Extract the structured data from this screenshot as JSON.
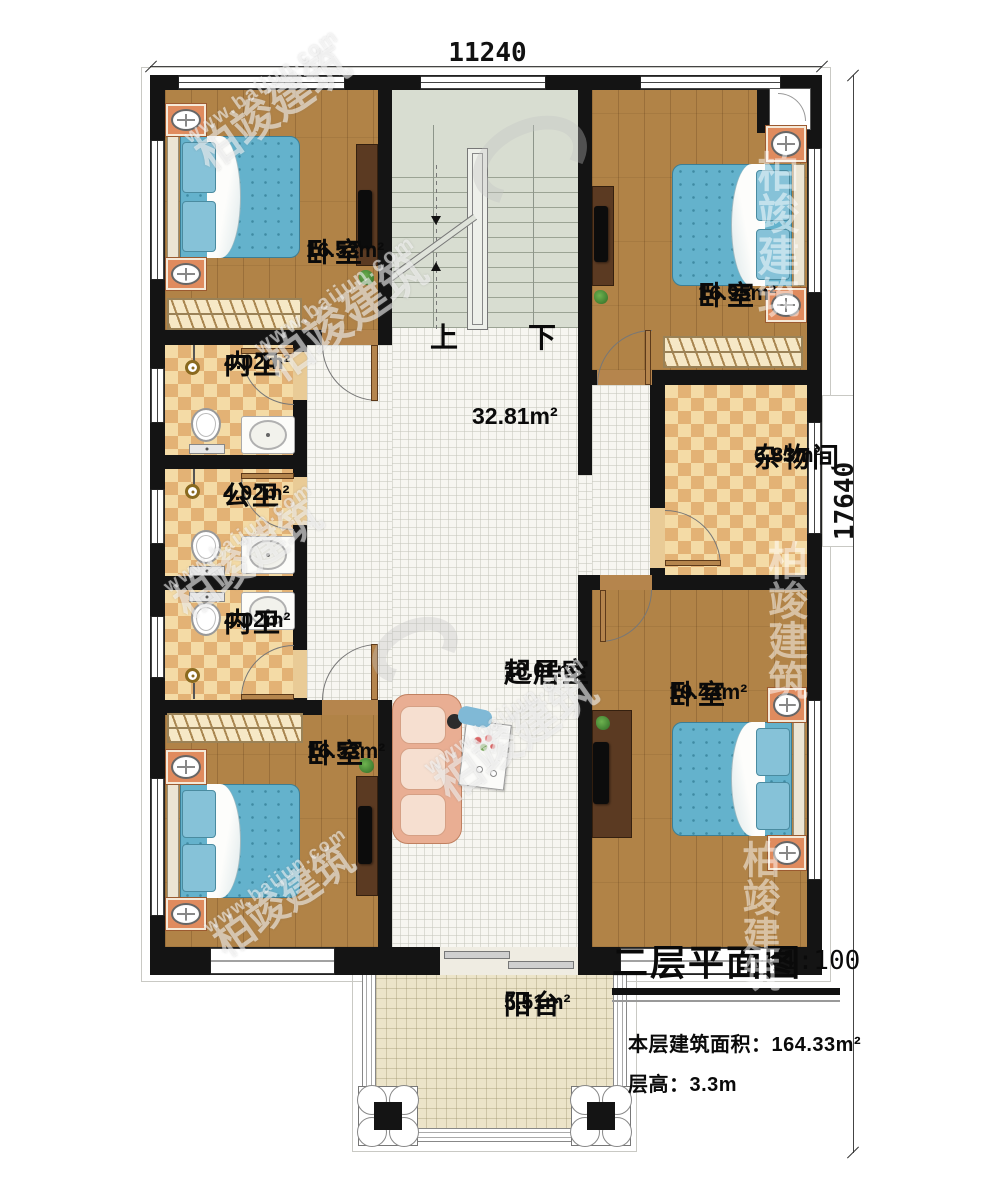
{
  "dimensions": {
    "top_width": "11240",
    "right_height": "17640"
  },
  "stairs": {
    "up_label": "上",
    "down_label": "下"
  },
  "rooms": {
    "bedroom_top_left": {
      "name": "卧室",
      "area": "16.53m²"
    },
    "bedroom_top_right": {
      "name": "卧室",
      "area": "16.95m²"
    },
    "bath_top": {
      "name": "内卫",
      "area": "4.02m²"
    },
    "bath_middle": {
      "name": "公卫",
      "area": "4.02m²"
    },
    "bath_bottom": {
      "name": "内卫",
      "area": "4.02m²"
    },
    "storage": {
      "name": "杂物间",
      "area": "6.83m²"
    },
    "hall": {
      "area": "32.81m²"
    },
    "living_room": {
      "name": "起居室",
      "area": "18.01m²"
    },
    "bedroom_bottom_left": {
      "name": "卧室",
      "area": "16.53m²"
    },
    "bedroom_bottom_right": {
      "name": "卧室",
      "area": "19.44m²"
    },
    "balcony": {
      "name": "阳台",
      "area": "5.51m²"
    }
  },
  "title_block": {
    "title": "二层平面图",
    "scale": "1:100",
    "building_area": "本层建筑面积：164.33m²",
    "floor_height": "层高：3.3m"
  },
  "watermark": {
    "brand": "柏竣建筑",
    "url": "www.baijun.com"
  },
  "colors": {
    "wall": "#141414",
    "wood_floor": "#b18347",
    "tile_floor": "#f7f6f1",
    "checker_light": "#f4dba6",
    "checker_dark": "#e3b275",
    "stair_floor": "#d8ddd1",
    "balcony_floor": "#ece4c9",
    "bed_blue": "#64b2cc"
  }
}
